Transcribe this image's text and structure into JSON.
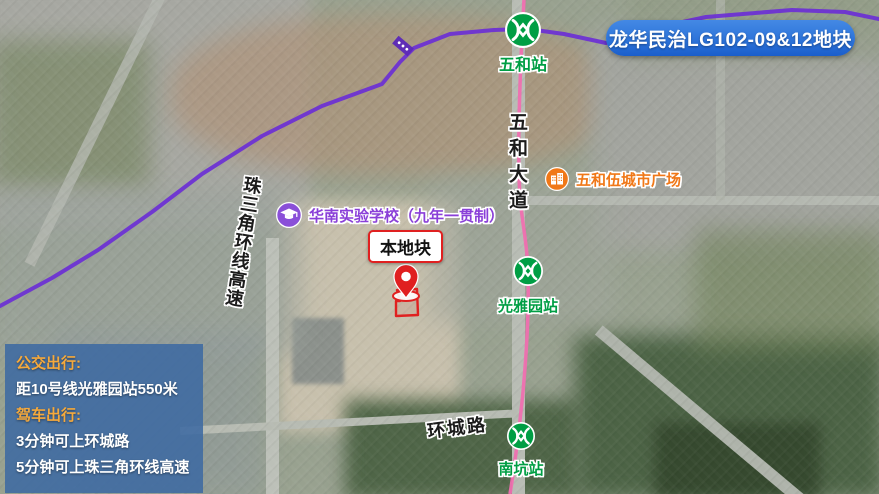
{
  "banner": {
    "title": "龙华民治LG102-09&12地块",
    "bg_color": "#2D74DA"
  },
  "map": {
    "stations": [
      {
        "name": "五和站"
      },
      {
        "name": "光雅园站"
      },
      {
        "name": "南坑站"
      }
    ],
    "roads": {
      "wuhe_avenue": "五和大道",
      "prd_ring_expressway": "珠三角环线高速",
      "huancheng_road": "环城路"
    },
    "pois": {
      "school": {
        "name": "华南实验学校（九年一贯制）",
        "color": "#8A3FD8"
      },
      "mall": {
        "name": "五和伍城市广场",
        "color": "#F07818"
      }
    },
    "plot": {
      "label": "本地块",
      "marker_color": "#E02020"
    },
    "lines": {
      "metro_line10_color": "#EF6FB0",
      "expressway_color": "#6B2FD5",
      "metro_logo_color": "#009E44"
    }
  },
  "infobox": {
    "bg_color": "rgba(61,106,162,0.88)",
    "heading_color": "#F5A93C",
    "lines": [
      {
        "text": "公交出行:",
        "style": "heading"
      },
      {
        "text": "距10号线光雅园站550米",
        "style": "body"
      },
      {
        "text": "驾车出行:",
        "style": "heading"
      },
      {
        "text": "3分钟可上环城路",
        "style": "body"
      },
      {
        "text": "5分钟可上珠三角环线高速",
        "style": "body"
      }
    ]
  }
}
